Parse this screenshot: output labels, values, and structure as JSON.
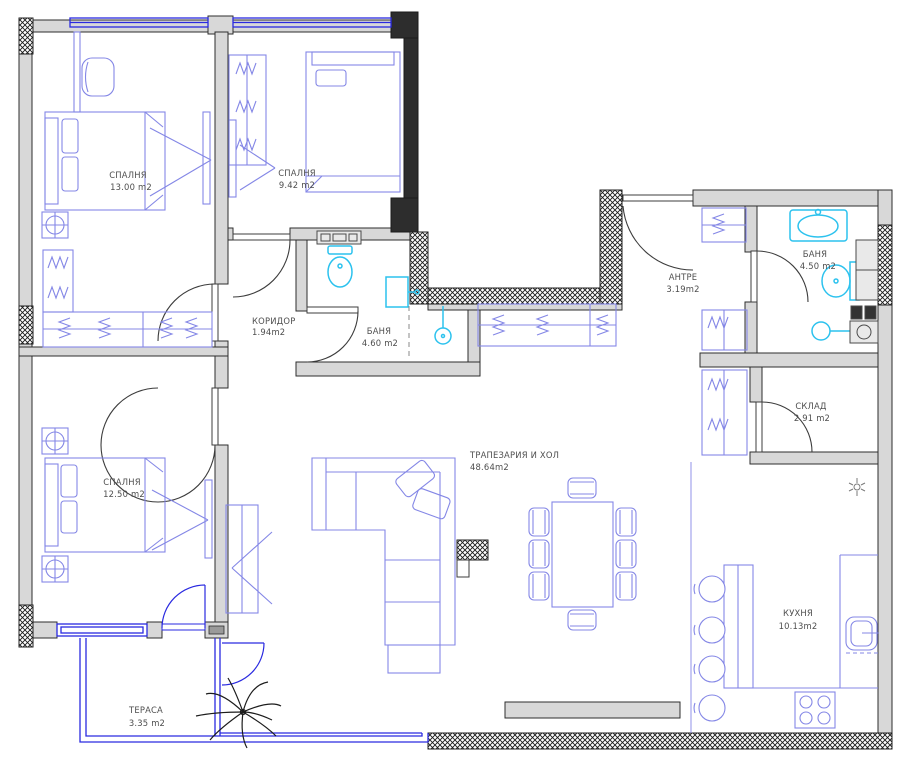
{
  "plan": {
    "title": "apartment-floor-plan",
    "rooms": [
      {
        "id": "bedroom-1",
        "name": "СПАЛНЯ",
        "area": "13.00 m2"
      },
      {
        "id": "bedroom-2",
        "name": "СПАЛНЯ",
        "area": "9.42 m2"
      },
      {
        "id": "corridor",
        "name": "КОРИДОР",
        "area": "1.94m2"
      },
      {
        "id": "bathroom-1",
        "name": "БАНЯ",
        "area": "4.60 m2"
      },
      {
        "id": "entry",
        "name": "АНТРЕ",
        "area": "3.19m2"
      },
      {
        "id": "bathroom-2",
        "name": "БАНЯ",
        "area": "4.50 m2"
      },
      {
        "id": "storage",
        "name": "СКЛАД",
        "area": "2.91 m2"
      },
      {
        "id": "living",
        "name": "ТРАПЕЗАРИЯ И ХОЛ",
        "area": "48.64m2"
      },
      {
        "id": "bedroom-3",
        "name": "СПАЛНЯ",
        "area": "12.50 m2"
      },
      {
        "id": "kitchen",
        "name": "КУХНЯ",
        "area": "10.13m2"
      },
      {
        "id": "terrace",
        "name": "ТЕРАСА",
        "area": "3.35 m2"
      }
    ],
    "colors": {
      "wall_fill": "#d8d8d8",
      "wall_stroke": "#2e2e2e",
      "dark_wall": "#2d2d2d",
      "furniture": "#8487e6",
      "fixture_cyan": "#2cc2ee",
      "window_blue": "#2a2ae0",
      "label_text": "#4e4e4e",
      "background": "#ffffff"
    }
  }
}
